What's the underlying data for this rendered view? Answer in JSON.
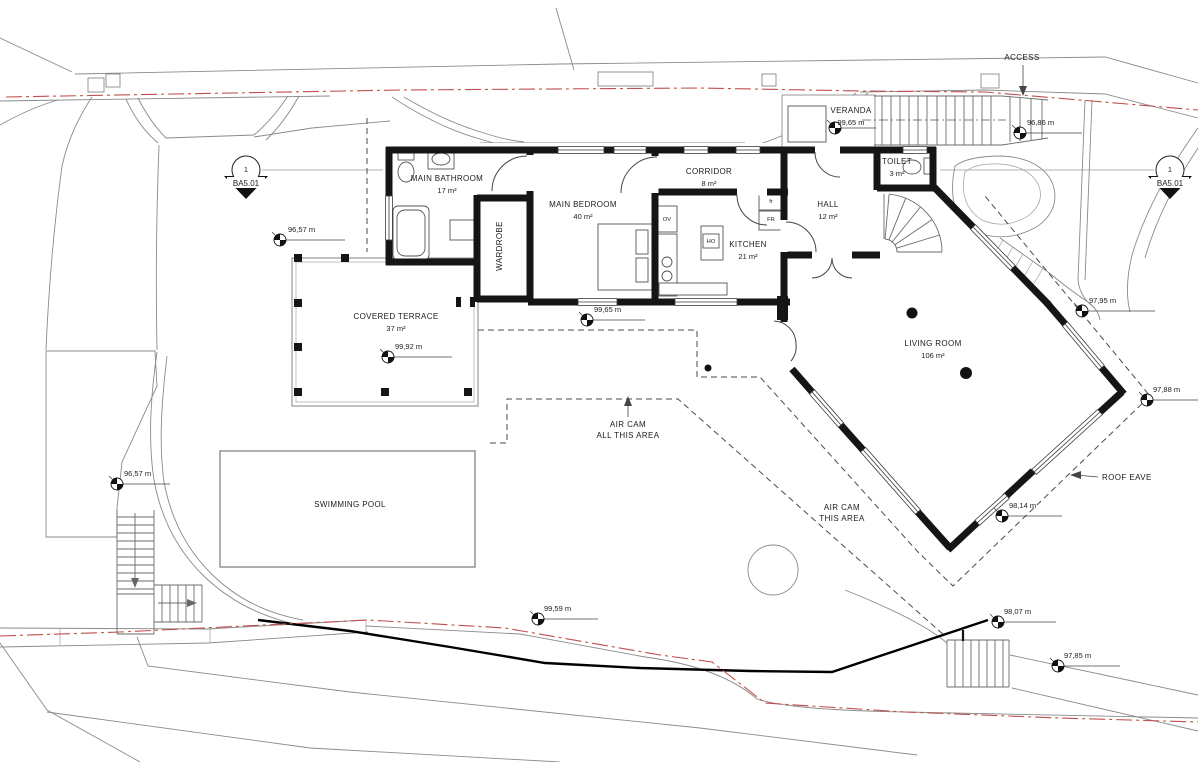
{
  "rooms": [
    {
      "name": "MAIN BATHROOM",
      "area": "17 m²",
      "x": 447,
      "y": 181
    },
    {
      "name": "MAIN BEDROOM",
      "area": "40 m²",
      "x": 583,
      "y": 207
    },
    {
      "name": "WARDROBE",
      "area": "",
      "x": 502,
      "y": 246,
      "rotate": -90
    },
    {
      "name": "CORRIDOR",
      "area": "8 m²",
      "x": 709,
      "y": 174
    },
    {
      "name": "KITCHEN",
      "area": "21 m²",
      "x": 748,
      "y": 247
    },
    {
      "name": "HALL",
      "area": "12 m²",
      "x": 828,
      "y": 207
    },
    {
      "name": "TOILET",
      "area": "3 m²",
      "x": 897,
      "y": 164
    },
    {
      "name": "VERANDA",
      "area": "99,65 m",
      "x": 851,
      "y": 113
    },
    {
      "name": "LIVING ROOM",
      "area": "106 m²",
      "x": 933,
      "y": 346
    },
    {
      "name": "COVERED TERRACE",
      "area": "37 m²",
      "x": 396,
      "y": 319
    },
    {
      "name": "SWIMMING POOL",
      "area": "",
      "x": 350,
      "y": 507
    }
  ],
  "appliances": [
    {
      "text": "OV",
      "x": 667,
      "y": 221
    },
    {
      "text": "fr",
      "x": 771,
      "y": 203
    },
    {
      "text": "FR",
      "x": 771,
      "y": 221
    },
    {
      "text": "HO",
      "x": 711,
      "y": 243
    }
  ],
  "elevations": [
    {
      "value": "96,57 m",
      "x": 280,
      "y": 240,
      "lx": 345,
      "tx": 288,
      "ty": 232
    },
    {
      "value": "96,57 m",
      "x": 117,
      "y": 484,
      "lx": 170,
      "tx": 124,
      "ty": 476
    },
    {
      "value": "96,86 m",
      "x": 1020,
      "y": 133,
      "lx": 1082,
      "tx": 1027,
      "ty": 125
    },
    {
      "value": "99,65 m",
      "x": 587,
      "y": 320,
      "lx": 645,
      "tx": 594,
      "ty": 312
    },
    {
      "value": "99,92 m",
      "x": 388,
      "y": 357,
      "lx": 452,
      "tx": 395,
      "ty": 349
    },
    {
      "value": "97,95 m",
      "x": 1082,
      "y": 311,
      "lx": 1155,
      "tx": 1089,
      "ty": 303
    },
    {
      "value": "97,88 m",
      "x": 1147,
      "y": 400,
      "lx": 1198,
      "tx": 1153,
      "ty": 392
    },
    {
      "value": "98,14 m",
      "x": 1002,
      "y": 516,
      "lx": 1062,
      "tx": 1009,
      "ty": 508
    },
    {
      "value": "98,07 m",
      "x": 998,
      "y": 622,
      "lx": 1056,
      "tx": 1004,
      "ty": 614
    },
    {
      "value": "97,85 m",
      "x": 1058,
      "y": 666,
      "lx": 1120,
      "tx": 1064,
      "ty": 658
    },
    {
      "value": "99,59 m",
      "x": 538,
      "y": 619,
      "lx": 598,
      "tx": 544,
      "ty": 611
    },
    {
      "value": "",
      "x": 835,
      "y": 128,
      "lx": 876,
      "tx": 842,
      "ty": 121
    }
  ],
  "annotations": {
    "access": "ACCESS",
    "roof_eave": "ROOF EAVE",
    "air_cam_all": [
      "AIR CAM",
      "ALL THIS AREA"
    ],
    "air_cam_this": [
      "AIR CAM",
      "THIS AREA"
    ]
  },
  "section_marker": {
    "number": "1",
    "sheet": "BA5.01"
  },
  "colors": {
    "boundary_red": "#c0504d",
    "walls": "#151515",
    "site_lines": "#8a8a8a"
  }
}
